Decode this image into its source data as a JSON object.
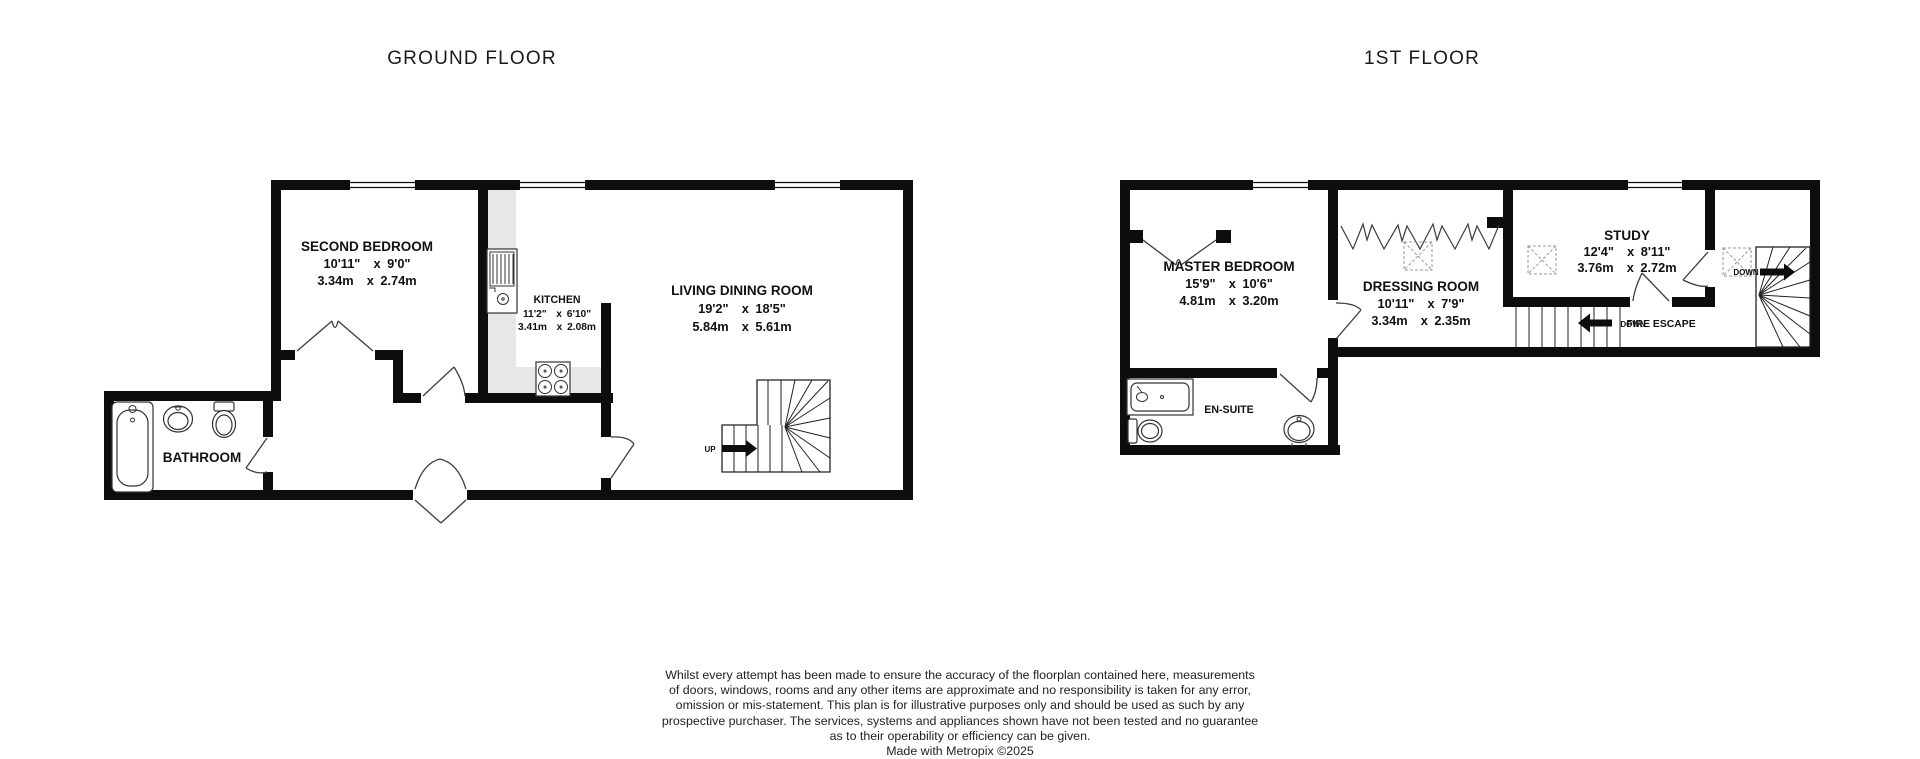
{
  "ground_floor": {
    "title": "GROUND FLOOR",
    "rooms": {
      "second_bedroom": {
        "name": "SECOND BEDROOM",
        "imperial": "10'11\"  x 9'0\"",
        "metric": "3.34m  x 2.74m"
      },
      "kitchen": {
        "name": "KITCHEN",
        "imperial": "11'2\"  x 6'10\"",
        "metric": "3.41m  x 2.08m"
      },
      "living_dining_room": {
        "name": "LIVING DINING ROOM",
        "imperial": "19'2\"  x 18'5\"",
        "metric": "5.84m  x 5.61m"
      },
      "bathroom": {
        "name": "BATHROOM"
      }
    },
    "stairs": {
      "direction_label": "UP"
    }
  },
  "first_floor": {
    "title": "1ST FLOOR",
    "rooms": {
      "master_bedroom": {
        "name": "MASTER BEDROOM",
        "imperial": "15'9\"  x 10'6\"",
        "metric": "4.81m  x 3.20m"
      },
      "dressing_room": {
        "name": "DRESSING ROOM",
        "imperial": "10'11\"  x 7'9\"",
        "metric": "3.34m  x 2.35m"
      },
      "study": {
        "name": "STUDY",
        "imperial": "12'4\"  x 8'11\"",
        "metric": "3.76m  x 2.72m"
      },
      "en_suite": {
        "name": "EN-SUITE"
      }
    },
    "stairs": {
      "direction_label": "DOWN"
    },
    "fire_escape": {
      "direction_label": "DOWN",
      "name": "FIRE ESCAPE"
    }
  },
  "footer": {
    "disclaimer": "Whilst every attempt has been made to ensure the accuracy of the floorplan contained here, measurements\nof doors, windows, rooms and any other items are approximate and no responsibility is taken for any error,\nomission or mis-statement. This plan is for illustrative purposes only and should be used as such by any\nprospective purchaser. The services, systems and appliances shown have not been tested and no guarantee\nas to their operability or efficiency can be given.",
    "credit": "Made with Metropix ©2025"
  },
  "colors": {
    "wall": "#0d0d0d",
    "counter": "#e7e7e7",
    "text": "#111111"
  }
}
